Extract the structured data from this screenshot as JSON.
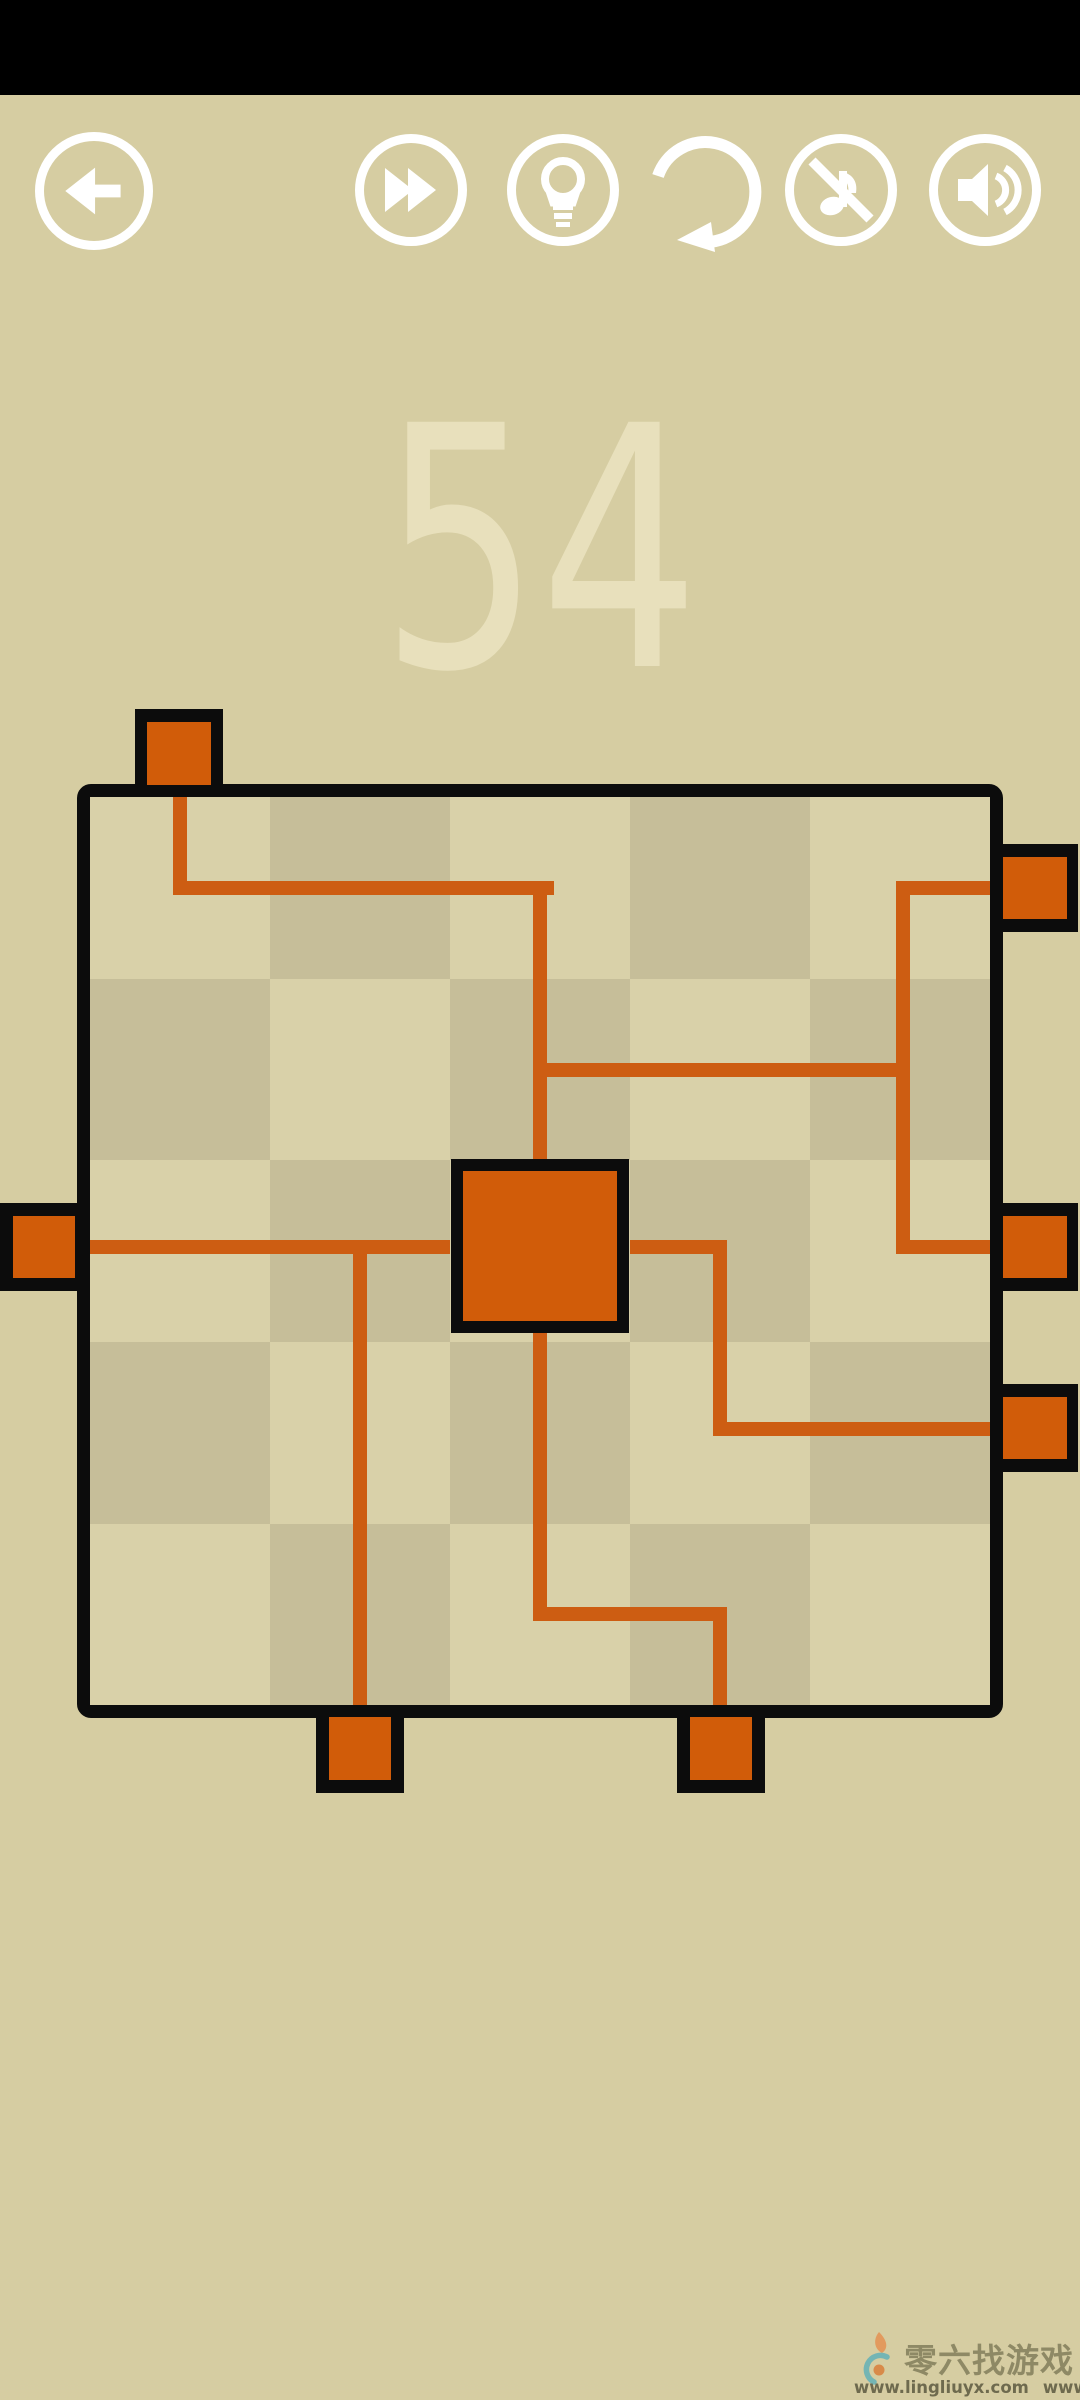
{
  "app": {
    "background": "#d6cda2",
    "status_bar_color": "#000000",
    "icon_color": "#ffffff",
    "black": "#0c0c0c"
  },
  "toolbar": {
    "back_button": {
      "icon": "back-arrow-icon"
    },
    "buttons": [
      {
        "id": "skip",
        "icon": "fast-forward-icon"
      },
      {
        "id": "hint",
        "icon": "lightbulb-icon"
      },
      {
        "id": "restart",
        "icon": "restart-arrow-icon"
      },
      {
        "id": "music",
        "icon": "music-off-icon"
      },
      {
        "id": "sound",
        "icon": "sound-on-icon"
      }
    ]
  },
  "level": {
    "number": "54",
    "color": "#e8e0bc"
  },
  "board": {
    "x": 77,
    "y": 784,
    "width": 926,
    "height": 934,
    "border": 13,
    "grid": {
      "rows": 5,
      "cols": 5,
      "light_cell_color": "#d9d1a9",
      "dark_cell_color": "#c6be99",
      "col_edges": [
        0,
        180,
        360,
        540,
        720,
        900
      ],
      "row_edges": [
        0,
        182,
        363,
        545,
        727,
        908
      ]
    }
  },
  "puzzle": {
    "pipe_color": "#cd5d12",
    "socket_color": "#d15c09",
    "pipe_width": 14,
    "pipes": [
      {
        "x": 83,
        "y": 0,
        "w": 14,
        "h": 98
      },
      {
        "x": 83,
        "y": 84,
        "w": 381,
        "h": 14
      },
      {
        "x": 443,
        "y": 84,
        "w": 14,
        "h": 278
      },
      {
        "x": 443,
        "y": 266,
        "w": 377,
        "h": 14
      },
      {
        "x": 806,
        "y": 84,
        "w": 14,
        "h": 373
      },
      {
        "x": 806,
        "y": 84,
        "w": 94,
        "h": 14
      },
      {
        "x": 806,
        "y": 443,
        "w": 94,
        "h": 14
      },
      {
        "x": 0,
        "y": 443,
        "w": 360,
        "h": 14
      },
      {
        "x": 263,
        "y": 443,
        "w": 14,
        "h": 465
      },
      {
        "x": 443,
        "y": 533,
        "w": 14,
        "h": 291
      },
      {
        "x": 443,
        "y": 810,
        "w": 194,
        "h": 14
      },
      {
        "x": 623,
        "y": 810,
        "w": 14,
        "h": 98
      },
      {
        "x": 540,
        "y": 443,
        "w": 97,
        "h": 14
      },
      {
        "x": 623,
        "y": 443,
        "w": 14,
        "h": 196
      },
      {
        "x": 623,
        "y": 625,
        "w": 277,
        "h": 14
      }
    ],
    "center_block": {
      "x": 361,
      "y": 362,
      "w": 178,
      "h": 174
    },
    "connectors": [
      {
        "side": "top",
        "box": [
          135,
          709,
          88,
          88
        ],
        "fill": [
          12,
          13,
          64,
          63
        ]
      },
      {
        "side": "left",
        "box": [
          0,
          1203,
          90,
          88
        ],
        "fill": [
          13,
          13,
          62,
          62
        ]
      },
      {
        "side": "right",
        "box": [
          990,
          844,
          88,
          88
        ],
        "fill": [
          13,
          13,
          64,
          62
        ]
      },
      {
        "side": "right",
        "box": [
          990,
          1203,
          88,
          88
        ],
        "fill": [
          13,
          13,
          64,
          62
        ]
      },
      {
        "side": "right",
        "box": [
          990,
          1384,
          88,
          88
        ],
        "fill": [
          13,
          13,
          64,
          62
        ]
      },
      {
        "side": "bottom",
        "box": [
          316,
          1705,
          88,
          88
        ],
        "fill": [
          13,
          12,
          62,
          63
        ]
      },
      {
        "side": "bottom",
        "box": [
          677,
          1705,
          88,
          88
        ],
        "fill": [
          13,
          12,
          62,
          63
        ]
      }
    ]
  },
  "watermark": {
    "logo": "flame-swirl-logo",
    "title": "零六找游戏",
    "title_color": "#8e8965",
    "urls": [
      "www.lingliuyx.com",
      "www.06zyx.com"
    ],
    "url_color": "#6e6a4e",
    "logo_flame_color": "#e29a5e",
    "logo_swirl_color": "#74b5b4"
  }
}
